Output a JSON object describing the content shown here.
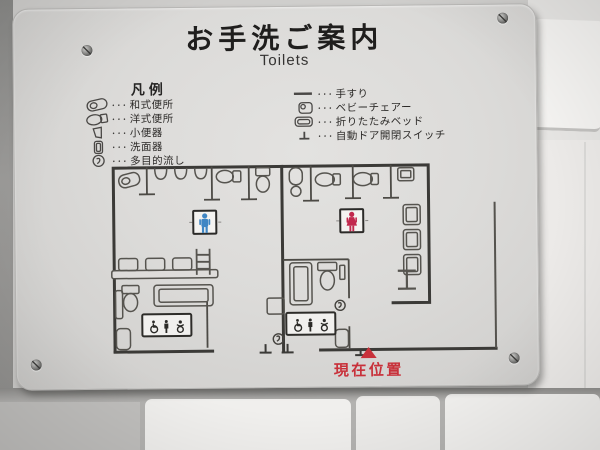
{
  "sign": {
    "title": "お手洗ご案内",
    "subtitle": "Toilets",
    "legend": {
      "heading": "凡例",
      "separator": "･･･",
      "left": [
        {
          "icon": "squat-toilet-icon",
          "label": "和式便所"
        },
        {
          "icon": "western-toilet-icon",
          "label": "洋式便所"
        },
        {
          "icon": "urinal-icon",
          "label": "小便器"
        },
        {
          "icon": "washbasin-icon",
          "label": "洗面器"
        },
        {
          "icon": "multipurpose-sink-icon",
          "label": "多目的流し"
        }
      ],
      "right": [
        {
          "icon": "handrail-icon",
          "label": "手すり"
        },
        {
          "icon": "baby-chair-icon",
          "label": "ベビーチェアー"
        },
        {
          "icon": "folding-bed-icon",
          "label": "折りたたみベッド"
        },
        {
          "icon": "auto-door-switch-icon",
          "label": "自動ドア開閉スイッチ"
        }
      ]
    },
    "map": {
      "current_location": "現在位置"
    },
    "colors": {
      "male_pictogram": "#3f86c4",
      "female_pictogram": "#c2294e",
      "current_location": "#c8313a",
      "wall_line": "#3b3a37"
    }
  }
}
